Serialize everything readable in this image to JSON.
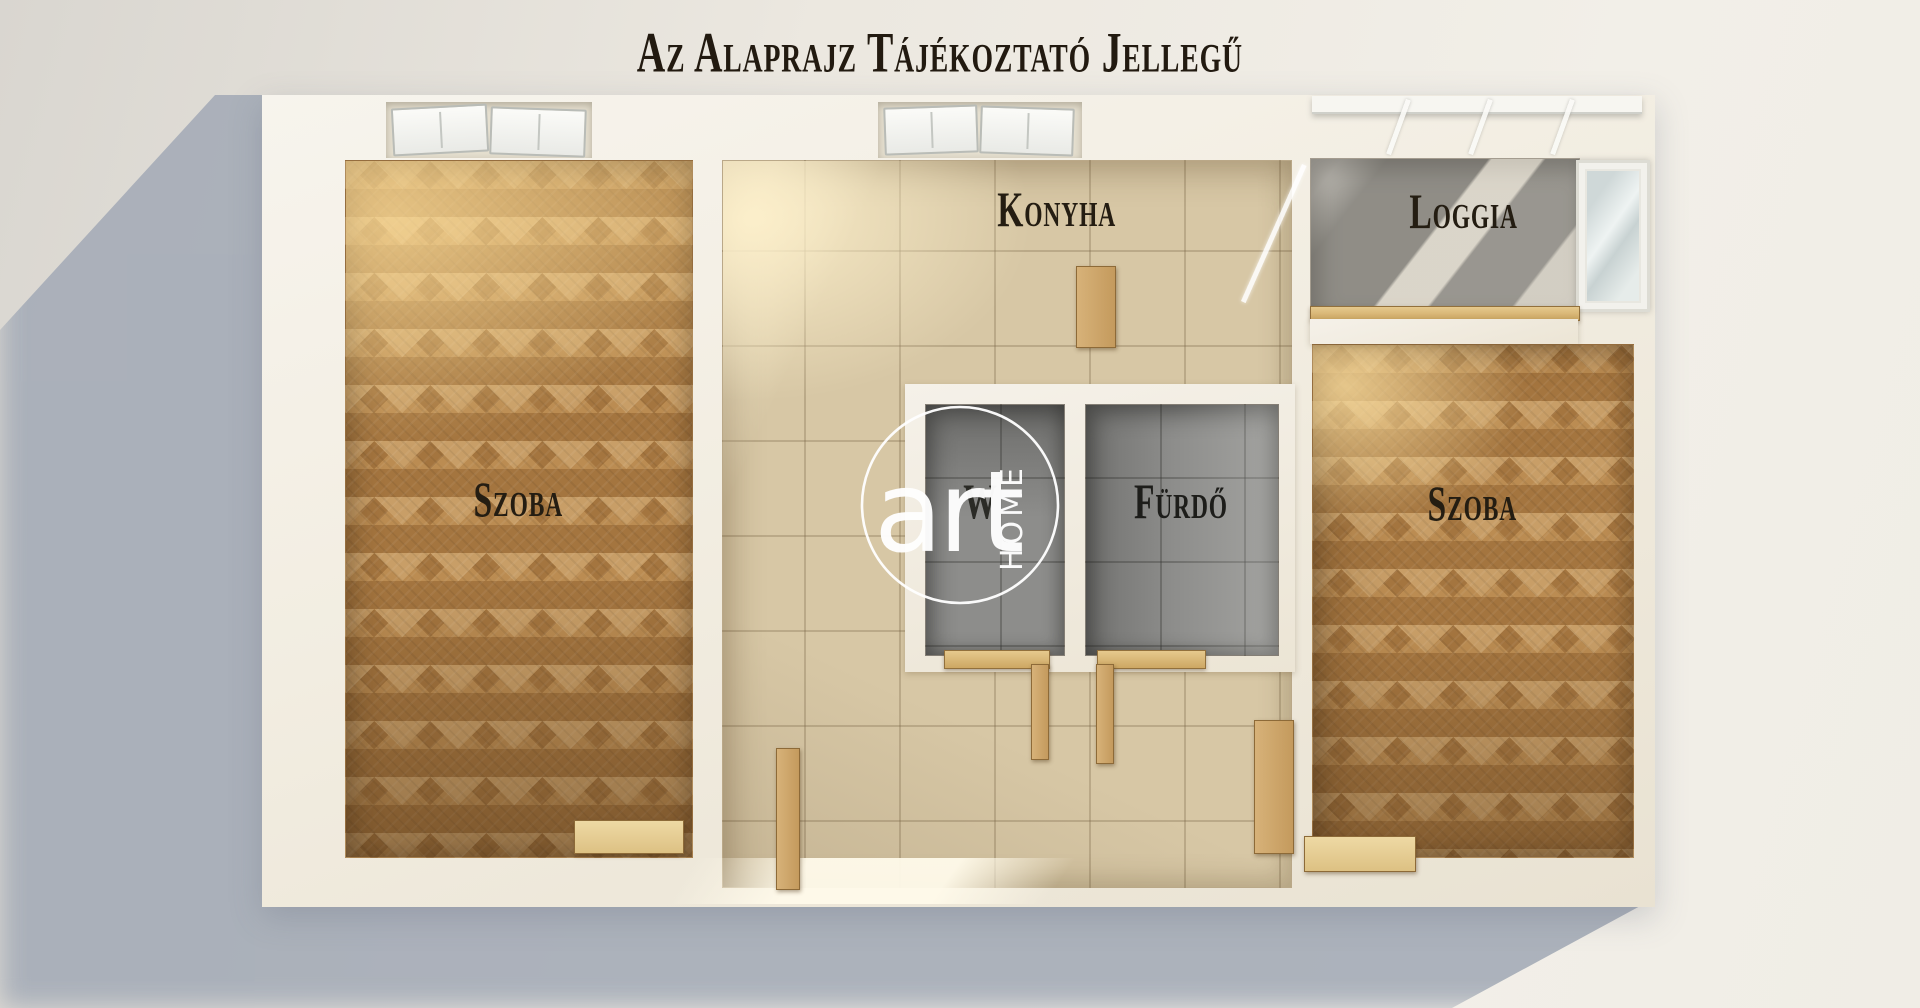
{
  "title": "Az alaprajz tájékoztató jellegű",
  "rooms": {
    "room_left": {
      "label": "Szoba"
    },
    "kitchen": {
      "label": "Konyha"
    },
    "loggia": {
      "label": "Loggia"
    },
    "wc": {
      "label": "W"
    },
    "bathroom": {
      "label": "Fürdő"
    },
    "room_right": {
      "label": "Szoba"
    }
  },
  "watermark": {
    "brand": "art",
    "word": "HOME"
  },
  "colors": {
    "background": "#ece8e0",
    "cast_shadow": "#a6adb8",
    "wall": "#f3efe6",
    "wood_floor": "#b08149",
    "tile_beige": "#d7c7a5",
    "tile_grey": "#8d8d8b",
    "loggia_concrete": "#b9b6af",
    "label_text": "#241d12",
    "watermark": "#ffffff"
  }
}
